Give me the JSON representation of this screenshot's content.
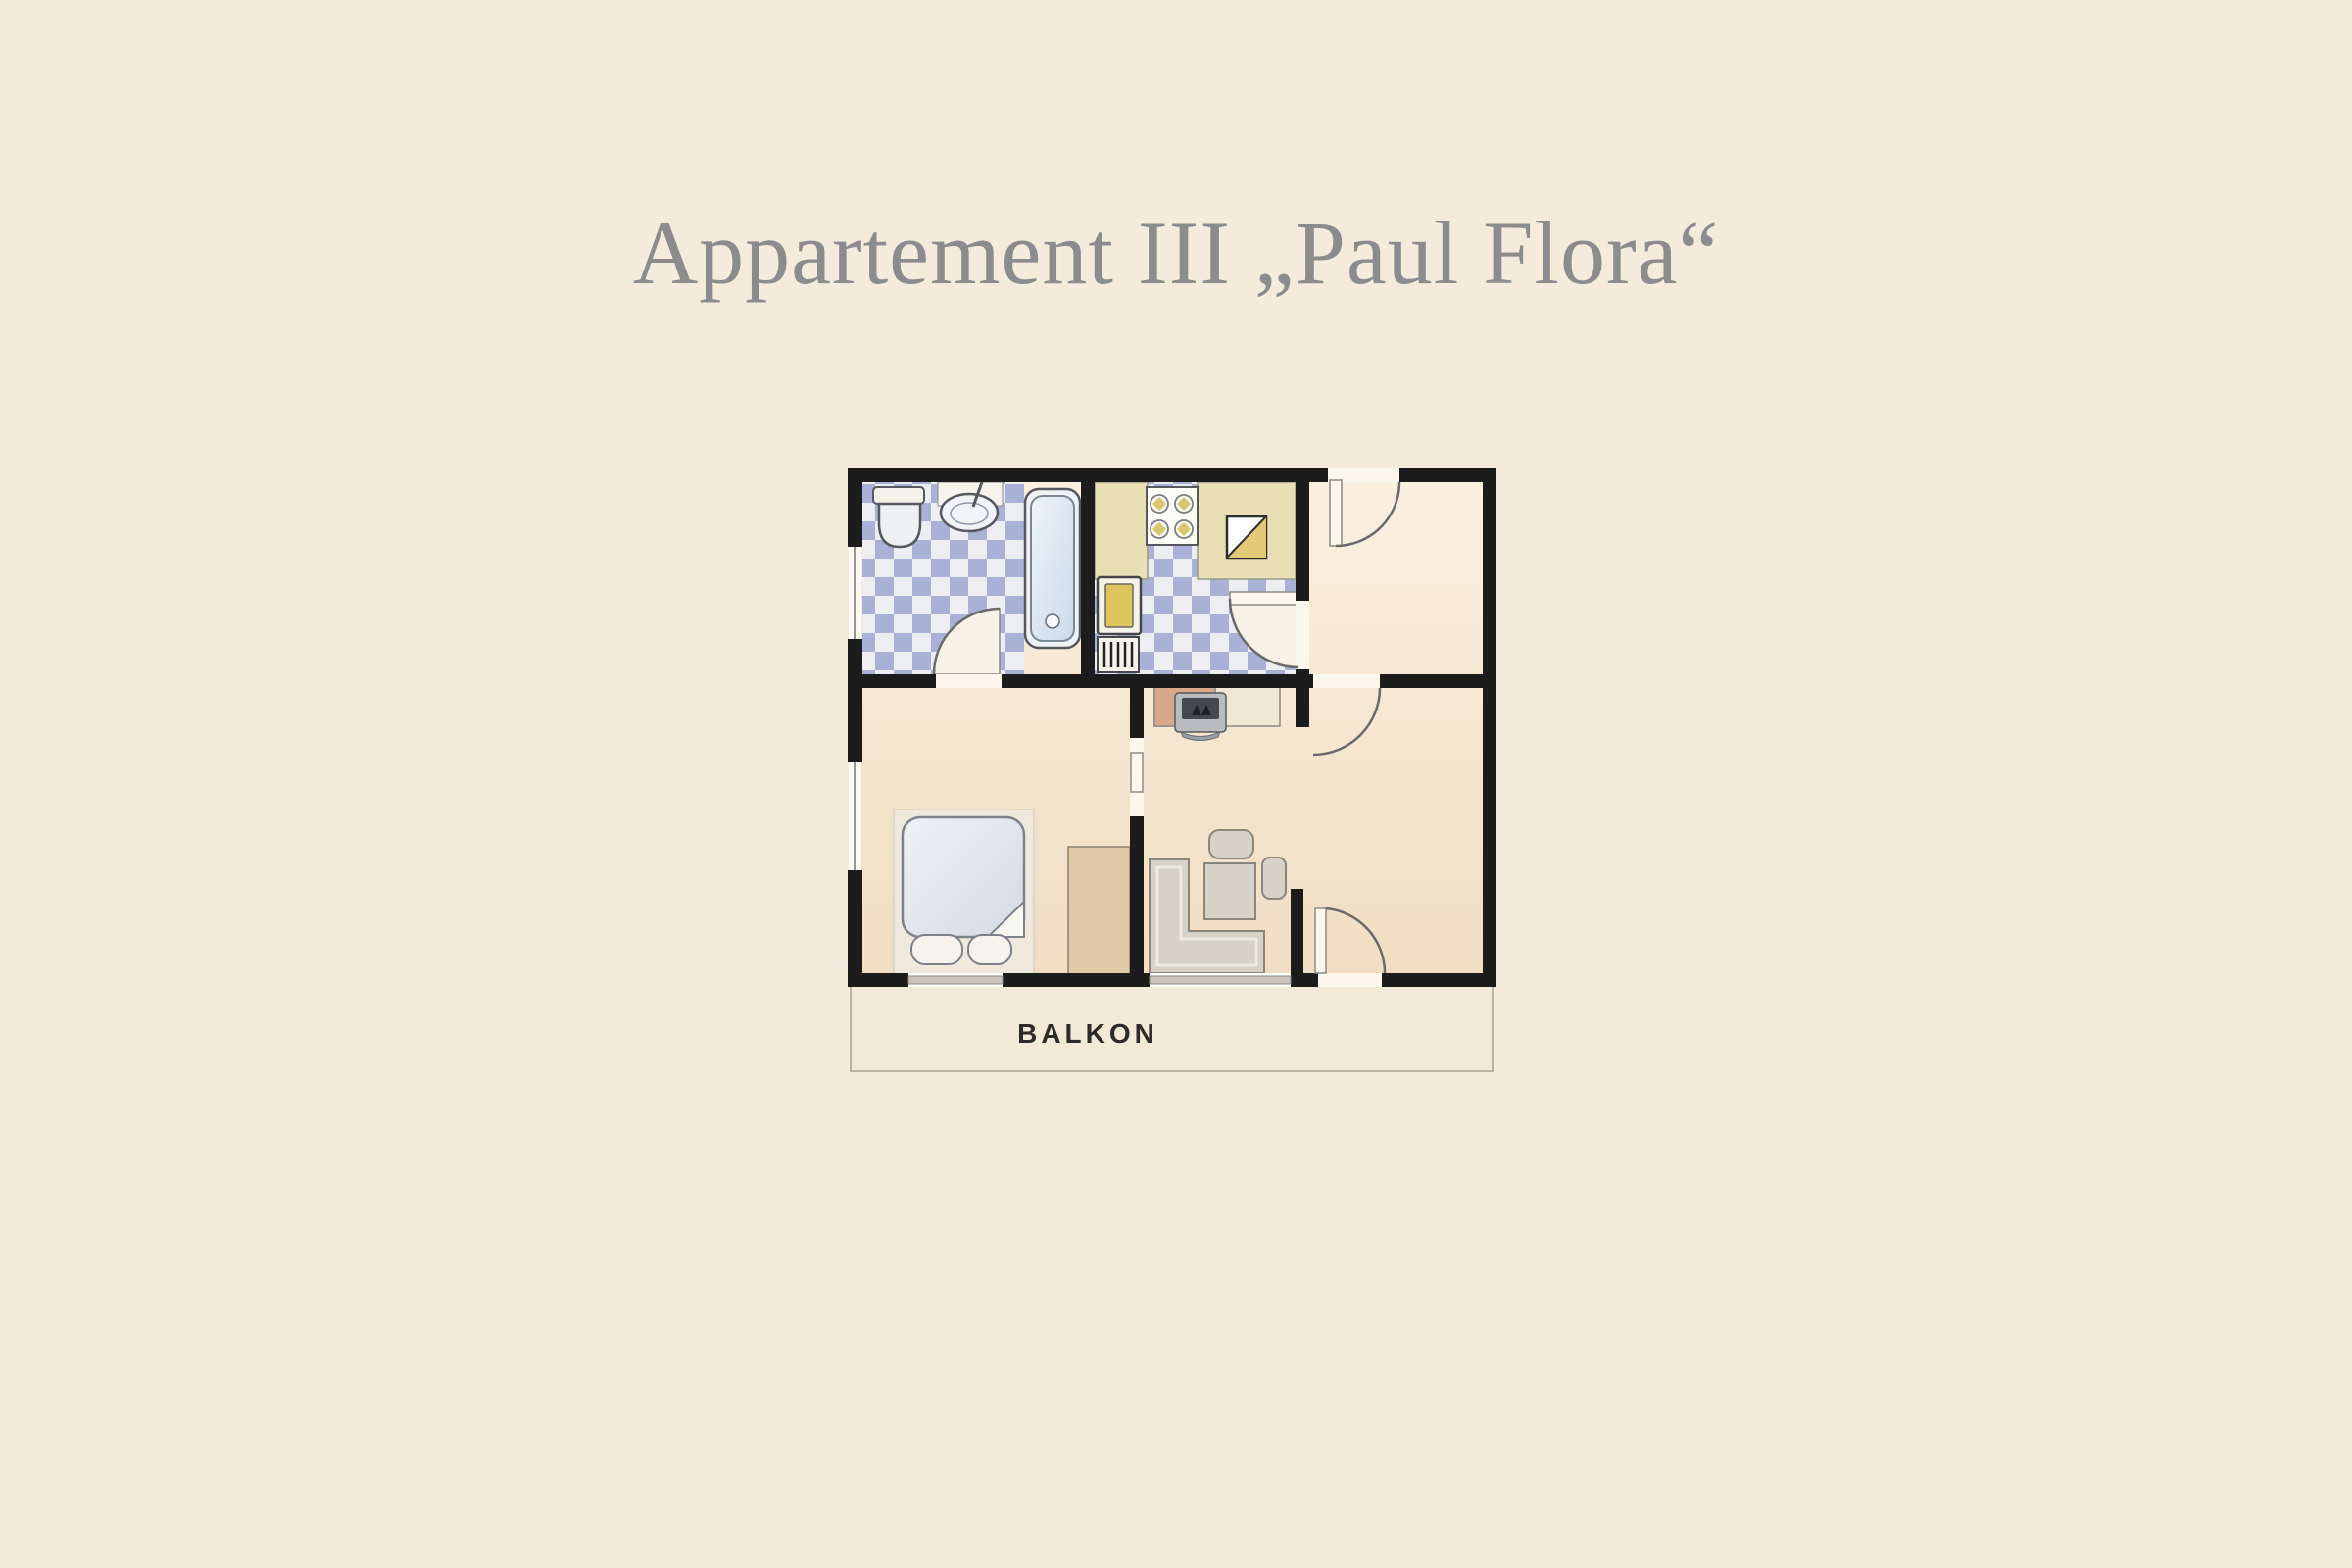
{
  "title": "Appartement III „Paul Flora“",
  "plan": {
    "balcony_label": "BALKON",
    "rooms": [
      {
        "name": "bathroom",
        "features": [
          "toilet",
          "washbasin",
          "bathtub",
          "checkered-tile-floor",
          "window",
          "door"
        ]
      },
      {
        "name": "kitchen",
        "features": [
          "counter",
          "stove-4-burners",
          "sink",
          "refrigerator",
          "radiator",
          "checkered-tile-floor",
          "door"
        ]
      },
      {
        "name": "hallway",
        "features": [
          "entrance-door"
        ]
      },
      {
        "name": "bedroom",
        "features": [
          "double-bed",
          "two-pillows",
          "wardrobe",
          "window",
          "window-left"
        ]
      },
      {
        "name": "living-room",
        "features": [
          "tv-on-sideboard",
          "corner-sofa",
          "table",
          "bench",
          "chair",
          "balcony-door",
          "window"
        ]
      },
      {
        "name": "balcony",
        "features": [
          "label"
        ]
      }
    ]
  },
  "colors": {
    "page_background": "#f4ebdc",
    "title_text": "#8c8c8e",
    "wall": "#1c1c1c",
    "floor_light": "#faf0e0",
    "floor_dark": "#f1ddc2",
    "tile_blue": "#a9b2d6",
    "tile_light": "#edeef2",
    "counter_tan": "#e9dfb4",
    "sink_yellow": "#e2ca76",
    "fridge_yellow": "#dfc55e",
    "tub_blue": "#ccdaea",
    "furniture_gray": "#d6d2c8",
    "wardrobe_tan": "#e2c9a7",
    "sideboard_salmon": "#d9a888",
    "balcony_fill": "#f3e9d7"
  }
}
